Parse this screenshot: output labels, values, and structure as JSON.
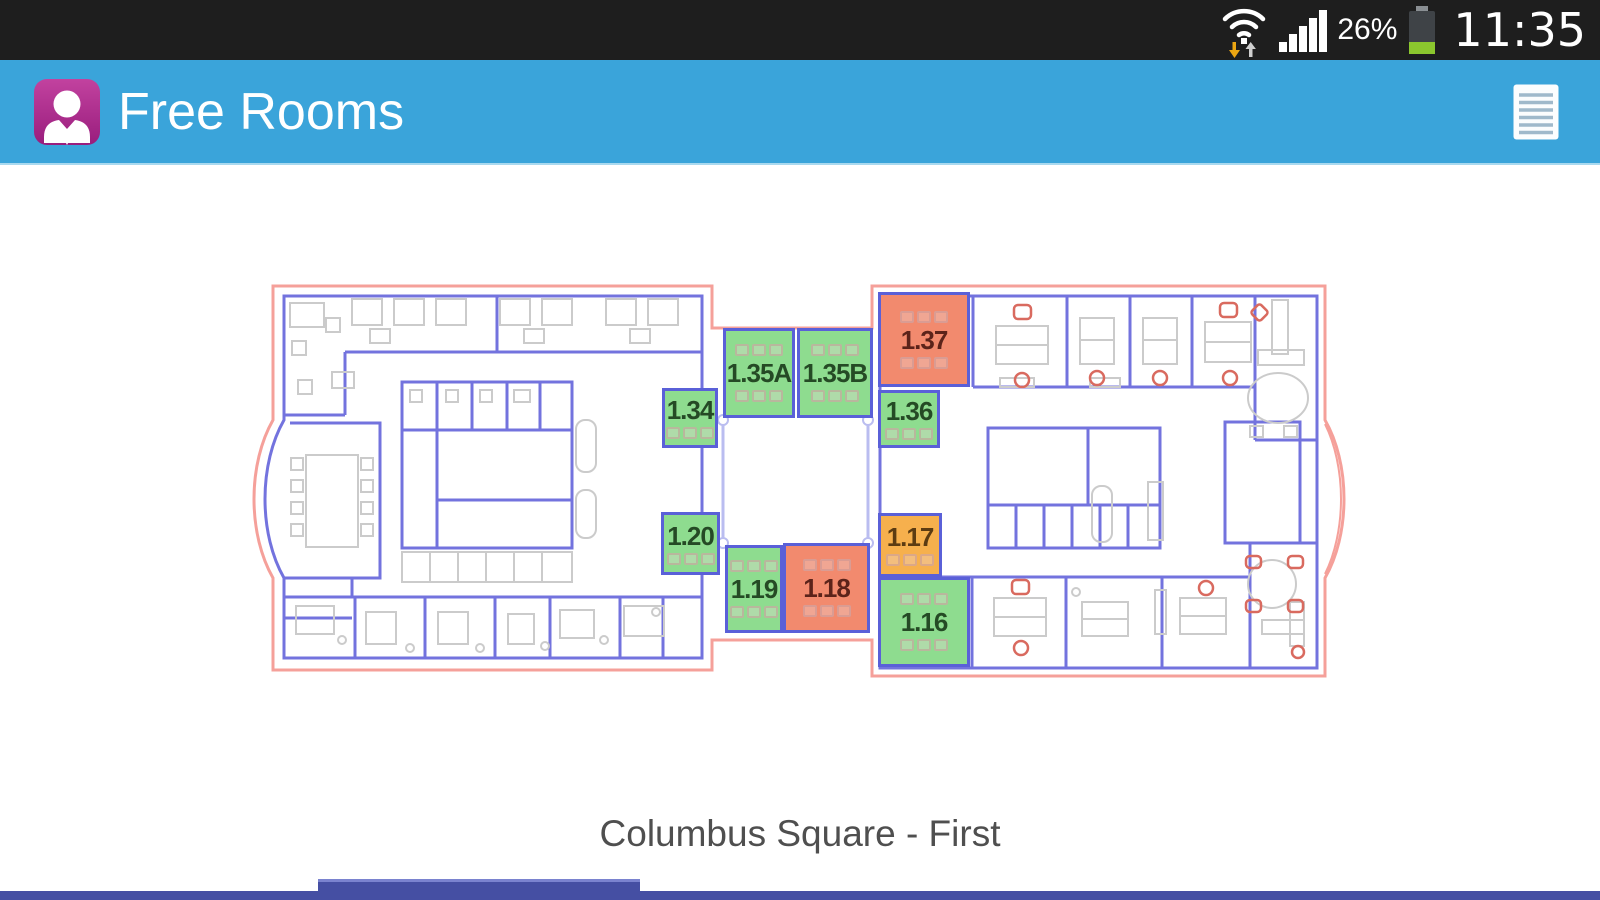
{
  "status_bar": {
    "battery_percent": "26%",
    "time": "11:35",
    "icons": [
      "wifi-updown-icon",
      "signal-bars-icon",
      "battery-icon"
    ]
  },
  "app_bar": {
    "title": "Free Rooms",
    "app_icon": "person-badge-icon",
    "menu_icon": "list-icon",
    "background": "#3aa4da"
  },
  "floorplan": {
    "caption": "Columbus Square - First",
    "legend_colors": {
      "free": "#8edc8f",
      "occupied": "#f28a6e",
      "partial": "#f6b04d"
    },
    "label_colors": {
      "free": "#254a25",
      "occupied": "#5c231a",
      "partial": "#5c3c12"
    },
    "rooms": [
      {
        "label": "1.35A",
        "status": "free",
        "x": 723,
        "y": 328,
        "w": 72,
        "h": 90
      },
      {
        "label": "1.35B",
        "status": "free",
        "x": 797,
        "y": 328,
        "w": 76,
        "h": 90
      },
      {
        "label": "1.37",
        "status": "occupied",
        "x": 878,
        "y": 292,
        "w": 92,
        "h": 95
      },
      {
        "label": "1.34",
        "status": "free",
        "x": 662,
        "y": 388,
        "w": 56,
        "h": 60
      },
      {
        "label": "1.36",
        "status": "free",
        "x": 878,
        "y": 390,
        "w": 62,
        "h": 58
      },
      {
        "label": "1.20",
        "status": "free",
        "x": 661,
        "y": 512,
        "w": 59,
        "h": 63
      },
      {
        "label": "1.19",
        "status": "free",
        "x": 725,
        "y": 545,
        "w": 58,
        "h": 88
      },
      {
        "label": "1.18",
        "status": "occupied",
        "x": 783,
        "y": 543,
        "w": 87,
        "h": 90
      },
      {
        "label": "1.17",
        "status": "partial",
        "x": 878,
        "y": 513,
        "w": 64,
        "h": 64
      },
      {
        "label": "1.16",
        "status": "free",
        "x": 878,
        "y": 577,
        "w": 92,
        "h": 90
      }
    ]
  }
}
